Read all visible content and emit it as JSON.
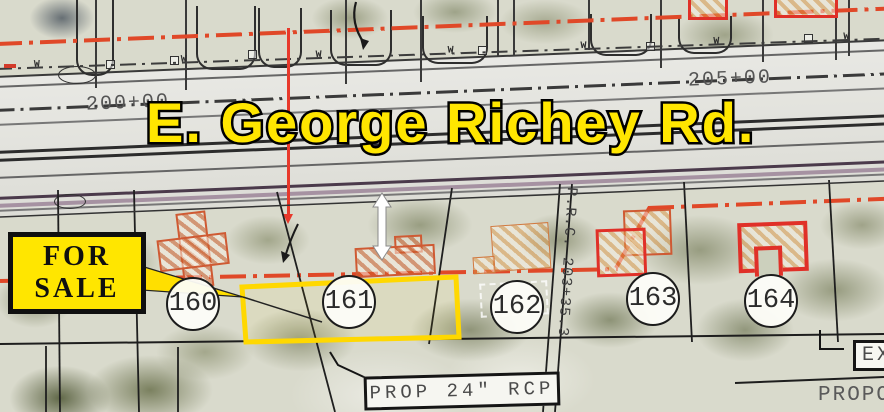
{
  "road": {
    "name": "E. George Richey Rd."
  },
  "sale_sign": {
    "line1": "FOR",
    "line2": "SALE"
  },
  "stations": {
    "left": "200+00",
    "right": "205+00"
  },
  "lots": [
    {
      "number": "160"
    },
    {
      "number": "161"
    },
    {
      "number": "162"
    },
    {
      "number": "163"
    },
    {
      "number": "164"
    }
  ],
  "annotations": {
    "prc_station": "P.R.C. 203+35.3",
    "pipe_callout": "PROP 24\" RCP",
    "exist_label_partial": "EXI",
    "proposed_label_partial": "PROPO",
    "water_mark": "W"
  },
  "colors": {
    "highlight_yellow": "#ffe600",
    "right_of_way_red": "#e04828",
    "building_red": "#e03028",
    "parcel_yellow": "#ffd800"
  }
}
